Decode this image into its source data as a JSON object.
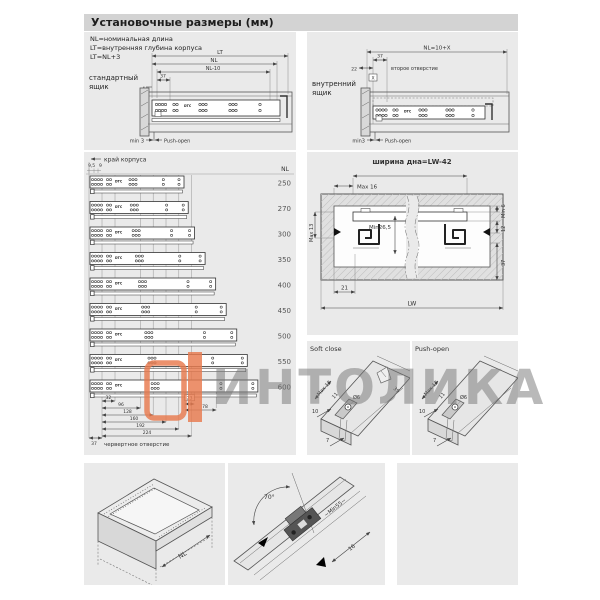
{
  "header": {
    "title": "Установочные размеры (мм)"
  },
  "watermark": {
    "text": "ИНТОЛИКА",
    "orange": "#e87a4e"
  },
  "top_left": {
    "notes": [
      "NL=номинальная длина",
      "LT=внутренняя глубина корпуса",
      "LT=NL+3"
    ],
    "label": [
      "стандартный",
      "ящик"
    ],
    "brand": "DTC",
    "dims": {
      "lt": "LT",
      "nl": "NL",
      "nl_minus_10": "NL-10",
      "d37": "37",
      "d4": "4",
      "min3": "min 3",
      "push_open": "Push-open"
    }
  },
  "top_right": {
    "label": [
      "внутренний",
      "ящик"
    ],
    "brand": "DTC",
    "dims": {
      "nl_formula": "NL=10+X",
      "d37": "37",
      "d22": "22",
      "x": "X",
      "second_hole": "второе отверстие",
      "min3": "min3",
      "push_open": "Push-open"
    }
  },
  "length_table": {
    "edge_label": "край корпуса",
    "dim_95": "9,5",
    "dim_9": "9",
    "nl_header": "NL",
    "brand": "DTC",
    "rows": [
      {
        "nl": 250
      },
      {
        "nl": 270
      },
      {
        "nl": 300
      },
      {
        "nl": 350
      },
      {
        "nl": 400
      },
      {
        "nl": 450
      },
      {
        "nl": 500
      },
      {
        "nl": 550
      },
      {
        "nl": 600
      }
    ],
    "front_dims": [
      "32",
      "96",
      "128",
      "160",
      "192",
      "224"
    ],
    "rear_dims": [
      "23",
      "78"
    ],
    "offset_dim": "37",
    "caption": "червертное отверстие"
  },
  "cross_section": {
    "title": "ширина дна=LW-42",
    "dims": {
      "max16": "Max 16",
      "min6": "Min 6",
      "max13": "Max 13",
      "min265": "Min26,5",
      "d12": "12",
      "d37": "37",
      "d21": "21",
      "lw": "LW"
    }
  },
  "soft_close": {
    "label": "Soft close",
    "dims": {
      "max13": "Max 13",
      "d11": "11",
      "d39": "39",
      "d10": "10",
      "dia6": "Ø6",
      "d7": "7"
    }
  },
  "push_open": {
    "label": "Push-open",
    "dims": {
      "max13": "Max 13",
      "d11": "11",
      "d10": "10",
      "dia6": "Ø6",
      "d7": "7"
    }
  },
  "drawer_iso": {
    "dim_nl": "NL"
  },
  "slide_iso": {
    "dims": {
      "angle": "70°",
      "min55": "~Min55~",
      "d16": "16"
    }
  }
}
